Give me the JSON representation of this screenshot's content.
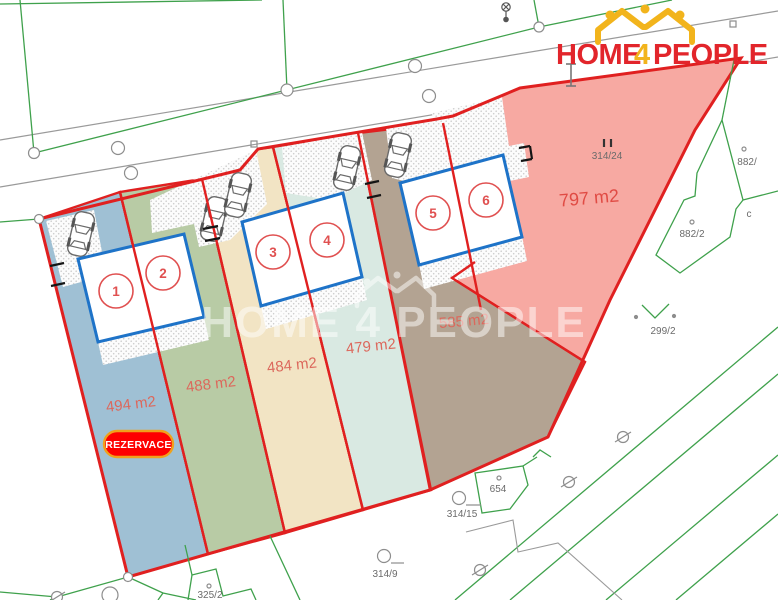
{
  "logo": {
    "home": "HOME",
    "four": "4",
    "people": "PEOPLE"
  },
  "watermark": {
    "text": "HOME 4 PEOPLE"
  },
  "reservation_badge": "REZERVACE",
  "plots": [
    {
      "number": "1",
      "area": "494 m2",
      "color": "#9fc0d4"
    },
    {
      "number": "2",
      "area": "488 m2",
      "color": "#b8cba5"
    },
    {
      "number": "3",
      "area": "484 m2",
      "color": "#f2e4c4"
    },
    {
      "number": "4",
      "area": "479 m2",
      "color": "#d9e9e2"
    },
    {
      "number": "5",
      "area": "585 m2",
      "color": "#b3a392"
    },
    {
      "number": "6",
      "area": "797 m2",
      "color": "#f7a9a2"
    }
  ],
  "parcels": {
    "p314_24": "314/24",
    "p882": "882/",
    "p882_2": "882/2",
    "p299_2": "299/2",
    "p654": "654",
    "p314_15": "314/15",
    "p314_9": "314/9",
    "p325_2": "325/2",
    "c": "c"
  },
  "colors": {
    "boundary_red": "#e02020",
    "building_blue": "#1e73c8",
    "cadastral_green": "#3fa14c",
    "area_label": "#dc685c",
    "pink_area": "#f7a9a2",
    "brown_area": "#b3a392",
    "logo_red": "#e2252b",
    "logo_gold": "#f2b41c",
    "badge_red": "#fe0000",
    "badge_border": "#f0a11c"
  }
}
